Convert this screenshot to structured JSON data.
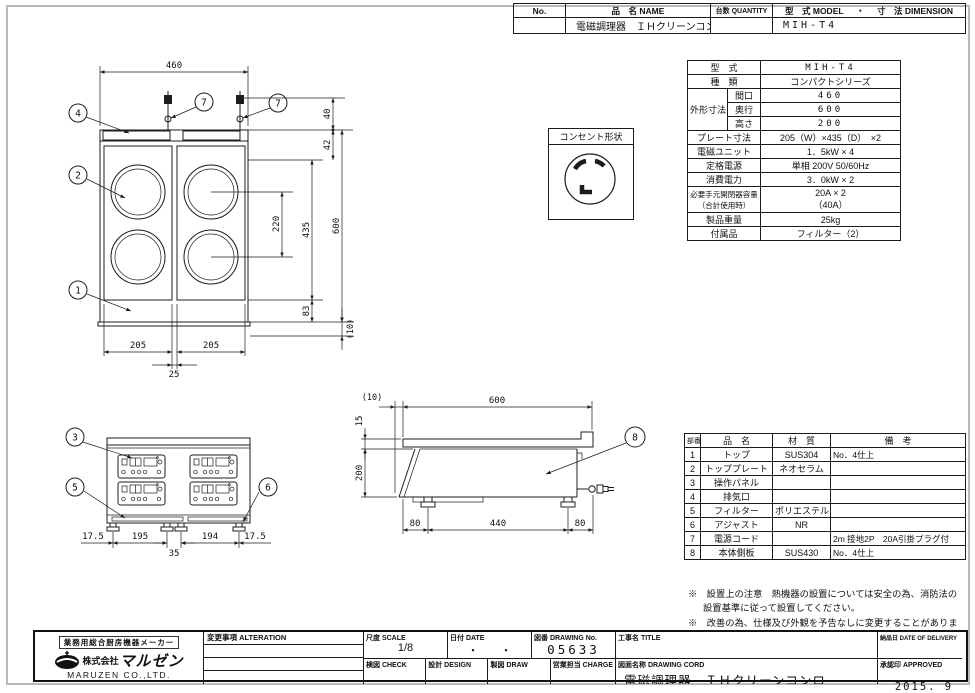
{
  "header_table": {
    "no_label": "No.",
    "name_label": "品　名 NAME",
    "qty_label": "台数 QUANTITY",
    "model_label": "型　式 MODEL",
    "sep_dot": "・",
    "dim_label": "寸　法 DIMENSION",
    "name_value": "電磁調理器　ＩＨクリーンコンロ",
    "model_value": "MIH-T4"
  },
  "spec_table": {
    "model_label": "型　式",
    "model_value": "MIH-T4",
    "kind_label": "種　類",
    "kind_value": "コンパクトシリーズ",
    "outer_label": "外形寸法",
    "w_label": "間口",
    "w_value": "460",
    "d_label": "奥行",
    "d_value": "600",
    "h_label": "高さ",
    "h_value": "200",
    "plate_label": "プレート寸法",
    "plate_value": "205（W）×435（D）　×2",
    "unit_label": "電磁ユニット",
    "unit_value": "1．5kW × 4",
    "rated_label": "定格電源",
    "rated_value": "単相 200V 50/60Hz",
    "power_label": "消費電力",
    "power_value": "3．0kW × 2",
    "breaker_label": "必要手元開閉器容量",
    "breaker_label2": "（合計使用時）",
    "breaker_value": "20A × 2",
    "breaker_value2": "（40A）",
    "weight_label": "製品重量",
    "weight_value": "25kg",
    "acc_label": "付属品",
    "acc_value": "フィルター（2）"
  },
  "outlet_box": {
    "title": "コンセント形状"
  },
  "parts_table": {
    "h_no": "部番",
    "h_name": "品　名",
    "h_mat": "材　質",
    "h_note": "備　考",
    "rows": [
      {
        "no": "1",
        "name": "トップ",
        "mat": "SUS304",
        "note": "No．4仕上"
      },
      {
        "no": "2",
        "name": "トッププレート",
        "mat": "ネオセラム",
        "note": ""
      },
      {
        "no": "3",
        "name": "操作パネル",
        "mat": "",
        "note": ""
      },
      {
        "no": "4",
        "name": "排気口",
        "mat": "",
        "note": ""
      },
      {
        "no": "5",
        "name": "フィルター",
        "mat": "ポリエステル",
        "note": ""
      },
      {
        "no": "6",
        "name": "アジャスト",
        "mat": "NR",
        "note": ""
      },
      {
        "no": "7",
        "name": "電源コード",
        "mat": "",
        "note": "2m 接地2P　20A引掛プラグ付"
      },
      {
        "no": "8",
        "name": "本体側板",
        "mat": "SUS430",
        "note": "No．4仕上"
      }
    ]
  },
  "notes": {
    "note1": "※　設置上の注意　熱機器の設置については安全の為、消防法の 設置基準に従って設置してください。",
    "note2": "※　改善の為、仕様及び外観を予告なしに変更することがあります。"
  },
  "title_block": {
    "maker_tagline": "業務用総合厨房機器メーカー",
    "company_prefix": "株式会社",
    "company_logo_text": "マルゼン",
    "company_en": "MARUZEN  CO.,LTD.",
    "alteration_label": "変更事項 ALTERATION",
    "scale_label": "尺度 SCALE",
    "scale_value": "1/8",
    "date_label": "日付 DATE",
    "date_value": "・　　・",
    "drawing_no_label": "図番 DRAWING No.",
    "drawing_no_value": "05633",
    "check_label": "検図 CHECK",
    "design_label": "設計 DESIGN",
    "draw_label": "製図 DRAW",
    "charge_label": "営業担当 CHARGE",
    "title_label": "工事名 TITLE",
    "drawing_name_label": "図面名称 DRAWING CORD",
    "drawing_name_value": "電磁調理器　ＩＨクリーンコンロ",
    "delivery_label": "納品日 DATE OF DELIVERY",
    "approved_label": "承認印 APPROVED",
    "issue_date": "2015. 9"
  },
  "drawings": {
    "top_view": {
      "dim_width": "460",
      "dim_plate_l": "205",
      "dim_plate_r": "205",
      "dim_gap": "25",
      "dim_cord": "40",
      "dim_front": "42",
      "dim_pitch": "220",
      "dim_plate_d": "435",
      "dim_depth": "600",
      "dim_back": "83",
      "dim_base": "(10)",
      "callout_top": "1",
      "callout_plate": "2",
      "callout_vent": "4",
      "callout_cord_l": "7",
      "callout_cord_r": "7"
    },
    "front_view": {
      "dim_m_l": "17.5",
      "dim_span_l": "195",
      "dim_span_r": "194",
      "dim_m_r": "17.5",
      "dim_gap": "35",
      "callout_panel": "3",
      "callout_filter": "5",
      "callout_adjust": "6"
    },
    "side_view": {
      "dim_overhang": "(10)",
      "dim_depth": "600",
      "dim_plate_h": "15",
      "dim_height": "200",
      "dim_foot_f": "80",
      "dim_span": "440",
      "dim_foot_b": "80",
      "callout_side": "8"
    }
  }
}
